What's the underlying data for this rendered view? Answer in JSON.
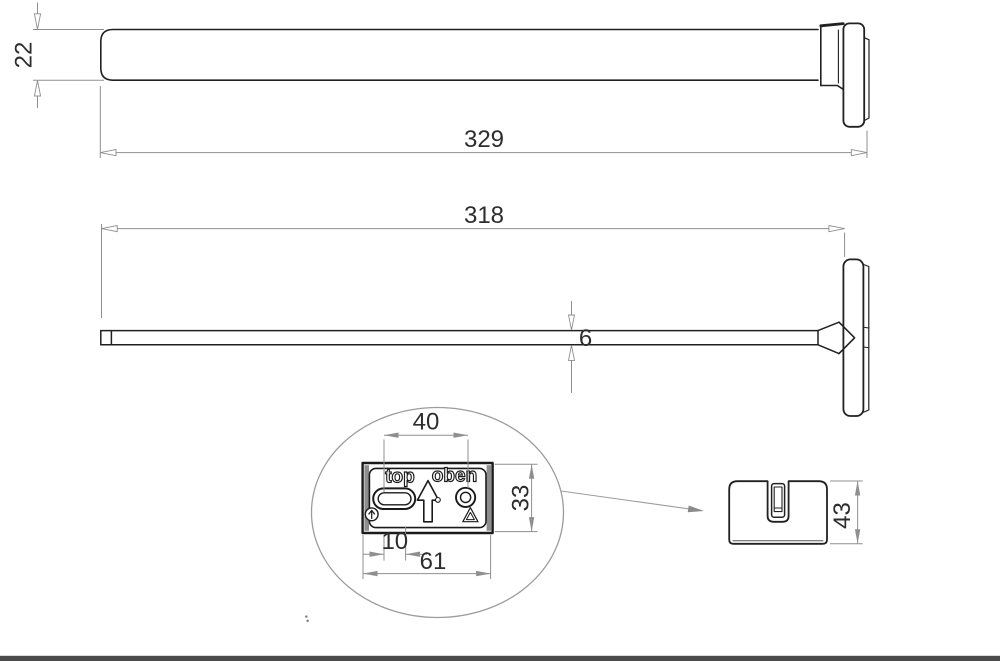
{
  "page": {
    "background_color": "#ffffff",
    "footer_bar_color": "#4b4b4b"
  },
  "drawing": {
    "line_color": "#212121",
    "dim_line_color": "#8f8f8f",
    "dim_text_color": "#2d2d2d",
    "detail_circle_color": "#9c9c9c",
    "top_view": {
      "bar_height": "22",
      "overall_length": "329"
    },
    "side_view": {
      "bar_length": "318",
      "bar_thickness": "6"
    },
    "detail_view": {
      "plate_label_left": "top",
      "plate_label_right": "oben",
      "hole_spacing": "40",
      "plate_height": "33",
      "slot_offset": "10",
      "plate_width": "61"
    },
    "end_cap_view": {
      "cap_height": "43"
    }
  }
}
